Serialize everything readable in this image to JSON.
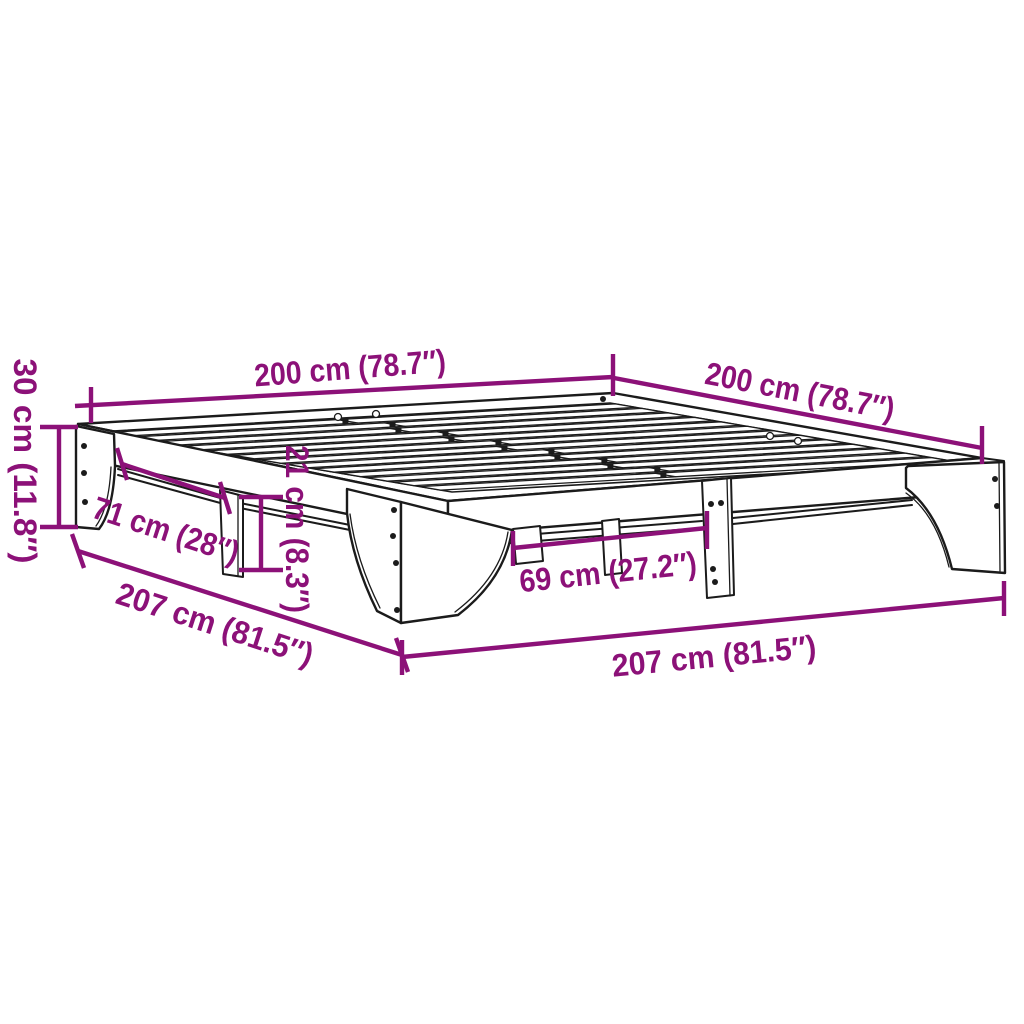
{
  "colors": {
    "dimension_accent": "#8C1178",
    "line_art": "#1b1b1b",
    "background": "#ffffff"
  },
  "dimensions": {
    "length_top_left": "200 cm (78.7″)",
    "width_top_right": "200 cm (78.7″)",
    "frame_height_left": "30 cm (11.8″)",
    "leg_spacing_left": "71 cm (28″)",
    "under_frame_clearance": "21 cm (8.3″)",
    "leg_spacing_right": "69 cm (27.2″)",
    "outer_length_diagonal": "207 cm (81.5″)",
    "outer_width_bottom": "207 cm (81.5″)"
  }
}
